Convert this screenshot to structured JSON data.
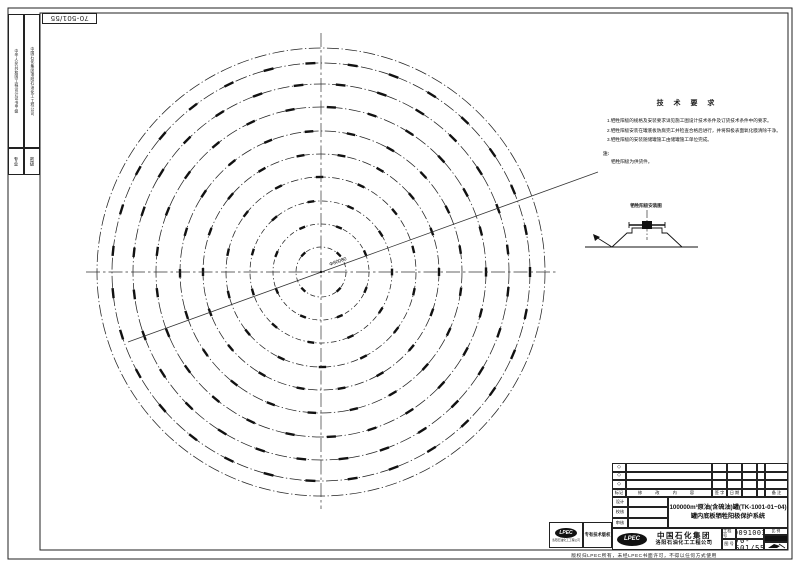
{
  "binding": {
    "flip_number": "70-501/55",
    "strip1": "中华人民共和国工程设计证书甲级",
    "strip2": "中国石化集团洛阳石油化工工程公司",
    "tag1": "专业",
    "tag2": "密级"
  },
  "tech": {
    "title": "技 术 要 求",
    "items": [
      "1.牺牲阳极的规格及安装要求详见施工图设计技术条件及订货技术条件中的要求。",
      "2.牺牲阳极安装在罐底板防腐完工并检查合格后进行，并将阳极表面氧化膜清除干净。",
      "3.牺牲阳极的安装随储罐施工由储罐施工单位完成。"
    ],
    "note_label": "注:",
    "note": "牺牲阳极为供货件。"
  },
  "detail": {
    "label": "牺牲阳极安装图"
  },
  "plan": {
    "cx": 321,
    "cy": 272,
    "shell_r": 224,
    "center_label": "Φ80000",
    "rings": [
      {
        "r": 25,
        "n": 4,
        "o": 45
      },
      {
        "r": 48,
        "n": 8,
        "o": 22
      },
      {
        "r": 71,
        "n": 11,
        "o": 0
      },
      {
        "r": 95,
        "n": 14,
        "o": 12
      },
      {
        "r": 118,
        "n": 18,
        "o": 0
      },
      {
        "r": 141,
        "n": 21,
        "o": 8
      },
      {
        "r": 165,
        "n": 25,
        "o": 0
      },
      {
        "r": 188,
        "n": 28,
        "o": 6
      },
      {
        "r": 209,
        "n": 31,
        "o": 0
      }
    ]
  },
  "title_block": {
    "rev": {
      "diamond": "◇",
      "mark": "标记",
      "content": "修  改  内  容",
      "sign": "签 字",
      "date": "日 期",
      "remark": "备 注"
    },
    "sign_rows": [
      "设计",
      "校核",
      "审核"
    ],
    "titles": {
      "line1": "100000m³原油(含硫油)罐(TK-1001-01~04)",
      "line2": "罐内底板牺牲阳极保护系统"
    },
    "company": {
      "logo": "LPEC",
      "line1": "中国石化集团",
      "line2": "洛阳石油化工工程公司"
    },
    "fields": {
      "project_no_label": "工程号",
      "project_no": "13009100301",
      "dwg_no_label": "图 号",
      "dwg_no": "70-501/55",
      "scale_label": "比 例"
    }
  },
  "stamp": {
    "logo": "LPEC",
    "caption": "洛阳石油化工工程公司",
    "label": "专有技术版权"
  },
  "footer_note": "版权归LPEC所有，未经LPEC书面许可，不得以任何方式使用"
}
